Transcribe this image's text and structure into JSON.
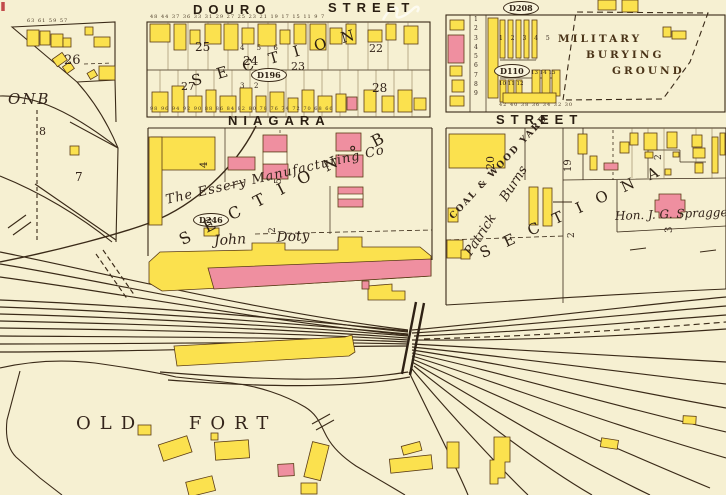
{
  "map": {
    "streets": {
      "douro": "DOURO",
      "douro_suffix": "STREET",
      "niagara": "NIAGARA",
      "niagara_suffix": "STREET"
    },
    "plates": {
      "d208": "D208",
      "d110": "D110",
      "d196": "D196",
      "d246": "D246"
    },
    "areas": {
      "military": [
        "MILITARY",
        "BURYING",
        "GROUND"
      ],
      "old_fort": "OLD FORT",
      "coal_yard": "COAL & WOOD YARD"
    },
    "owners": {
      "essery": "The Essery Manufacturing Co",
      "doty": "John Doty",
      "burns": "Patrick Burns",
      "spragge": "Hon. J. G. Spragge"
    },
    "sections": {
      "top": "S E C T I O N",
      "b": "S E C T I O N ° B",
      "a": "S E C T I O N A",
      "b_partial": "ONB"
    },
    "lots": {
      "nw_26": "26",
      "nw_8": "8",
      "nw_7": "7",
      "douro_25": "25",
      "douro_24": "24",
      "douro_23": "23",
      "douro_27": "27",
      "douro_22": "22",
      "douro_28": "28",
      "douro_small_456": "4 5 6",
      "douro_small_3": "3",
      "douro_small_2": "2",
      "east_column": "1\n2\n3\n4\n5\n6\n7\n8\n9",
      "east_row": "1 2 3 4 5",
      "d110_row_a": "10 11 12",
      "d110_row_b": "13 14 15",
      "coal_20": "20",
      "strip_19": "19",
      "houses_2": "2",
      "burns_2": "2",
      "essery_4": "4",
      "essery_5": "5",
      "essery_2": "2",
      "spragge_3": "3"
    },
    "addresses": {
      "douro_north": "48 44 37 36 33 31 29 27 25 23 21 19 17 15 11 9 7",
      "niagara_north": "98 96 94 92 90 88 86 84 82 80 78 76 74 72 70 68 66",
      "east_block": "42 40 38 36 34 32 30",
      "nw": "63 61 59 57"
    }
  },
  "palette": {
    "paper": "#F6F0D2",
    "building_wood": "#FBE14E",
    "building_brick": "#EF8FA0",
    "ink": "#3A2A18"
  }
}
